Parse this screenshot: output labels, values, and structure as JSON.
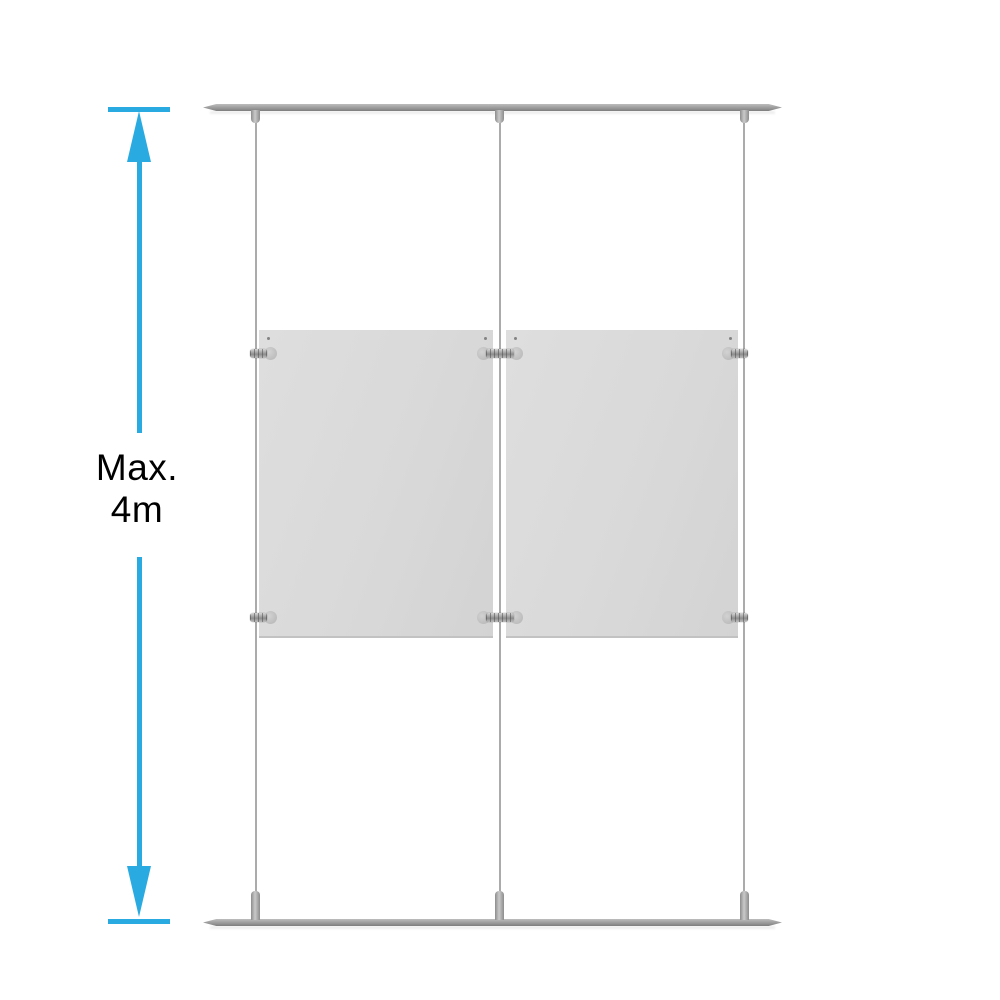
{
  "dimension": {
    "line1": "Max.",
    "line2": "4m"
  },
  "colors": {
    "accent": "#29ABE2",
    "background": "#FFFFFF",
    "rail": "#9B9B9B",
    "cable": "#ABABAB",
    "panel": "#D9D9D9",
    "text": "#000000"
  },
  "scene": {
    "rail_count": 2,
    "cable_count": 3,
    "panel_count": 2,
    "clamp_count": 6
  }
}
